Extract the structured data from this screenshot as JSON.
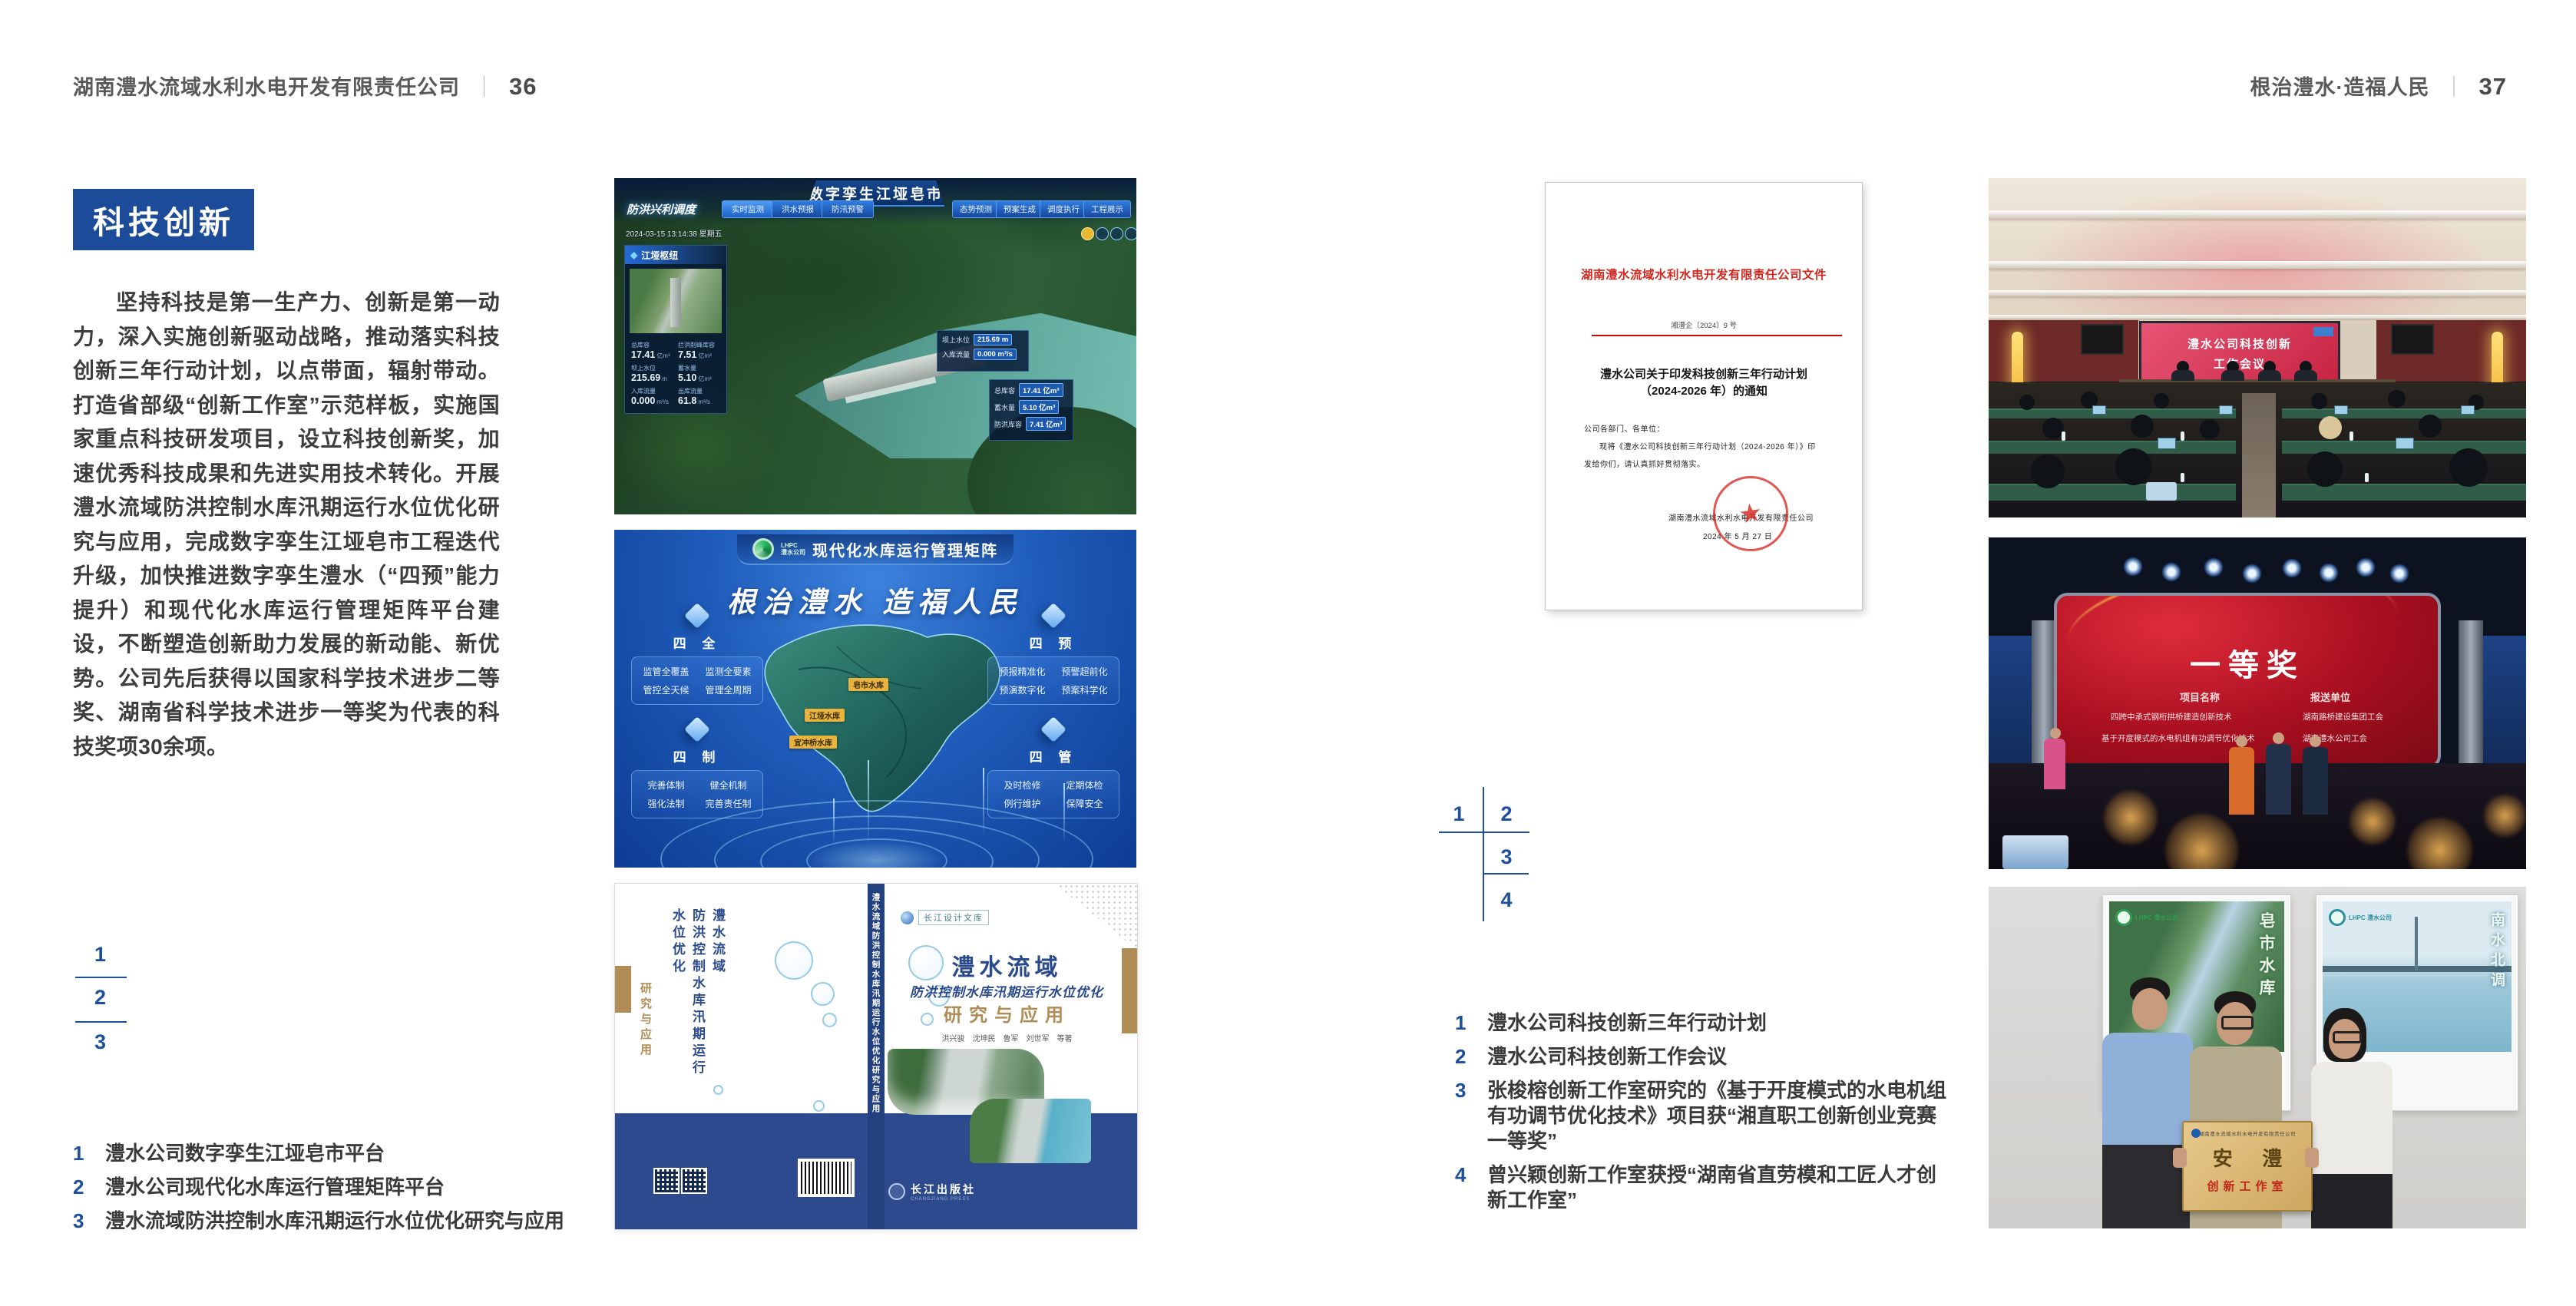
{
  "header_left": {
    "company": "湖南澧水流域水利水电开发有限责任公司",
    "sep": "｜",
    "page": "36"
  },
  "header_right": {
    "slogan": "根治澧水·造福人民",
    "sep": "｜",
    "page": "37"
  },
  "left": {
    "badge": "科技创新",
    "para": "坚持科技是第一生产力、创新是第一动力，深入实施创新驱动战略，推动落实科技创新三年行动计划，以点带面，辐射带动。打造省部级“创新工作室”示范样板，实施国家重点科技研发项目，设立科技创新奖，加速优秀科技成果和先进实用技术转化。开展澧水流域防洪控制水库汛期运行水位优化研究与应用，完成数字孪生江垭皂市工程迭代升级，加快推进数字孪生澧水（“四预”能力提升）和现代化水库运行管理矩阵平台建设，不断塑造创新助力发展的新动能、新优势。公司先后获得以国家科学技术进步二等奖、湖南省科学技术进步一等奖为代表的科技奖项30余项。",
    "markers": [
      "1",
      "2",
      "3"
    ],
    "captions": [
      {
        "n": "1",
        "t": "澧水公司数字孪生江垭皂市平台"
      },
      {
        "n": "2",
        "t": "澧水公司现代化水库运行管理矩阵平台"
      },
      {
        "n": "3",
        "t": "澧水流域防洪控制水库汛期运行水位优化研究与应用"
      }
    ]
  },
  "right": {
    "markers": [
      "1",
      "2",
      "3",
      "4"
    ],
    "captions": [
      {
        "n": "1",
        "t": "澧水公司科技创新三年行动计划"
      },
      {
        "n": "2",
        "t": "澧水公司科技创新工作会议"
      },
      {
        "n": "3",
        "t": "张梭榕创新工作室研究的《基于开度模式的水电机组有功调节优化技术》项目获“湘直职工创新创业竞赛一等奖”"
      },
      {
        "n": "4",
        "t": "曾兴颖创新工作室获授“湖南省直劳模和工匠人才创新工作室”"
      }
    ]
  },
  "fig1": {
    "title": "数字孪生江垭皂市",
    "module": "防洪兴利调度",
    "tabs_left": [
      "实时监测",
      "洪水预报",
      "防汛预警"
    ],
    "tabs_right": [
      "态势预测",
      "预案生成",
      "调度执行",
      "工程展示"
    ],
    "timestamp": "2024-03-15 13:14:38 星期五",
    "panel_title": "江垭枢纽",
    "stats": [
      {
        "label": "总库容",
        "value": "17.41",
        "unit": "亿m³"
      },
      {
        "label": "拦洪削峰库容",
        "value": "7.51",
        "unit": "亿m³"
      },
      {
        "label": "坝上水位",
        "value": "215.69",
        "unit": "m"
      },
      {
        "label": "蓄水量",
        "value": "5.10",
        "unit": "亿m³"
      },
      {
        "label": "入库流量",
        "value": "0.000",
        "unit": "m³/s"
      },
      {
        "label": "出库流量",
        "value": "61.8",
        "unit": "m³/s"
      }
    ],
    "popup": [
      {
        "label": "坝上水位",
        "value": "215.69 m"
      },
      {
        "label": "入库流量",
        "value": "0.000 m³/s"
      }
    ],
    "panel2": [
      {
        "label": "总库容",
        "value": "17.41 亿m³"
      },
      {
        "label": "蓄水量",
        "value": "5.10 亿m³"
      },
      {
        "label": "防洪库容",
        "value": "7.41 亿m³"
      }
    ]
  },
  "fig2": {
    "logo_en": "LHPC",
    "logo_cn": "澧水公司",
    "title": "现代化水库运行管理矩阵",
    "slogan": "根治澧水 造福人民",
    "modules": [
      {
        "name": "四 全",
        "items": [
          "监管全覆盖",
          "监测全要素",
          "管控全天候",
          "管理全周期"
        ]
      },
      {
        "name": "四 预",
        "items": [
          "预报精准化",
          "预警超前化",
          "预演数字化",
          "预案科学化"
        ]
      },
      {
        "name": "四 制",
        "items": [
          "完善体制",
          "健全机制",
          "强化法制",
          "完善责任制"
        ]
      },
      {
        "name": "四 管",
        "items": [
          "及时检修",
          "定期体检",
          "例行维护",
          "保障安全"
        ]
      }
    ],
    "map_labels": [
      "皂市水库",
      "江垭水库",
      "宜冲桥水库"
    ]
  },
  "fig3": {
    "imprint": "长江设计文库",
    "title1": "澧水流域",
    "title2": "防洪控制水库汛期运行水位优化",
    "title3": "研究与应用",
    "authors": "洪兴骏　沈坤民　鲁军　刘世军　等著",
    "spine": "澧水流域防洪控制水库汛期运行水位优化研究与应用",
    "back_title_a": "澧水流域",
    "back_title_b": "防洪控制水库汛期运行水位优化",
    "back_title_c": "研究与应用",
    "publisher": "长江出版社",
    "publisher_en": "CHANGJIANG PRESS"
  },
  "doc": {
    "header": "湖南澧水流域水利水电开发有限责任公司文件",
    "number": "湘澧企〔2024〕9 号",
    "title1": "澧水公司关于印发科技创新三年行动计划",
    "title2": "（2024-2026 年）的通知",
    "salutation": "公司各部门、各单位：",
    "body1": "现将《澧水公司科技创新三年行动计划（2024-2026 年）》印",
    "body2": "发给你们，请认真抓好贯彻落实。",
    "signer": "湖南澧水流域水利水电开发有限责任公司",
    "date": "2024 年 5 月 27 日",
    "seal_star": "★"
  },
  "photo_meeting": {
    "screen1": "澧水公司科技创新",
    "screen2": "工作会议"
  },
  "photo_award": {
    "title": "一等奖",
    "col1": "项目名称",
    "col2": "报送单位",
    "rows": [
      {
        "project": "四跨中承式钢桁拱桥建造创新技术",
        "unit": "湖南路桥建设集团工会"
      },
      {
        "project": "基于开度模式的水电机组有功调节优化技术",
        "unit": "湖南澧水公司工会"
      }
    ]
  },
  "photo_group": {
    "poster_left_logo": "LHPC 澧水公司",
    "poster_left_text": "皂市水库",
    "poster_right_logo": "LHPC 澧水公司",
    "poster_right_text": "南水北调",
    "plaque_header": "湖南澧水流域水利水电开发有限责任公司",
    "plaque_main": "安 澧",
    "plaque_sub": "创新工作室"
  }
}
